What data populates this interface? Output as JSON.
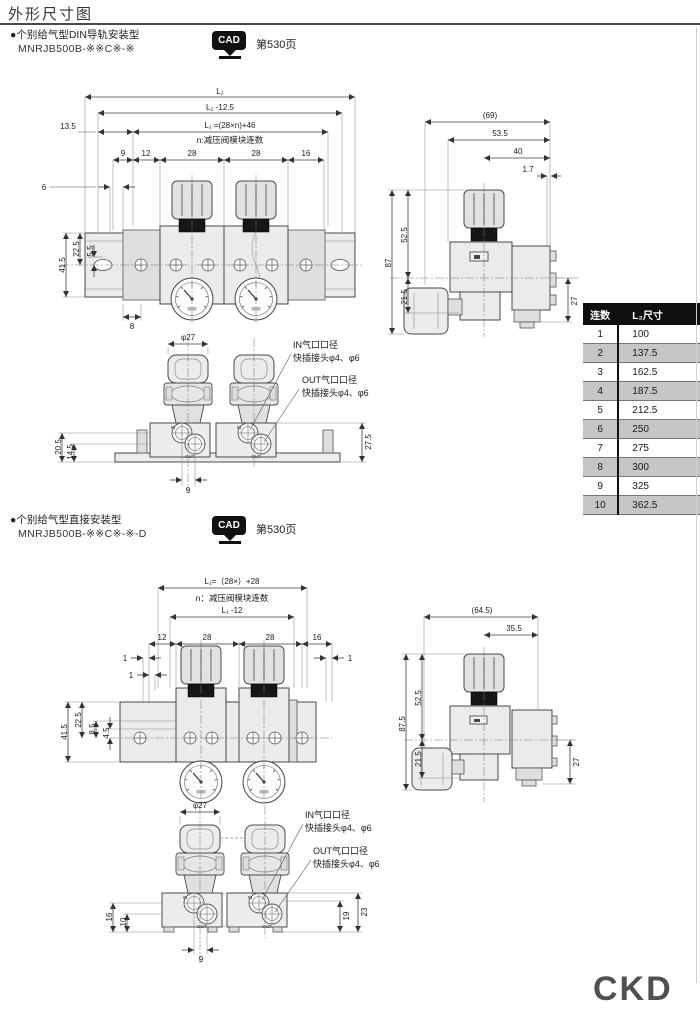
{
  "page": {
    "title": "外形尺寸图",
    "logo": "CKD"
  },
  "section1": {
    "bullet": "●个别给气型DIN导轨安装型",
    "model": "MNRJB500B-※※C※-※",
    "cad_label": "CAD",
    "cad_page": "第530页",
    "front": {
      "l2": "L₂",
      "l2m": "L₂ -12.5",
      "d135": "13.5",
      "l1": "L₁ =(28×n)+46",
      "note": "n:减压阀模块连数",
      "d9": "9",
      "d12": "12",
      "d28a": "28",
      "d28b": "28",
      "d16": "16",
      "d6": "6",
      "d415": "41.5",
      "d225": "22.5",
      "d55": "5.5",
      "d8": "8"
    },
    "side": {
      "d69": "(69)",
      "d535": "53.5",
      "d40": "40",
      "d17": "1.7",
      "d87": "87",
      "d525": "52.5",
      "d215": "21.5",
      "d27": "27"
    },
    "bottom": {
      "phi": "φ27",
      "in1": "IN气口口径",
      "in2": "快插接头φ4、φ6",
      "out1": "OUT气口口径",
      "out2": "快插接头φ4、φ6",
      "d205": "20.5",
      "d145": "14.5",
      "d9": "9",
      "d275": "27.5",
      "pin": "IN",
      "pout": "OUT"
    }
  },
  "table": {
    "col1": "连数",
    "col2": "L₂尺寸",
    "rows": [
      [
        "1",
        "100"
      ],
      [
        "2",
        "137.5"
      ],
      [
        "3",
        "162.5"
      ],
      [
        "4",
        "187.5"
      ],
      [
        "5",
        "212.5"
      ],
      [
        "6",
        "250"
      ],
      [
        "7",
        "275"
      ],
      [
        "8",
        "300"
      ],
      [
        "9",
        "325"
      ],
      [
        "10",
        "362.5"
      ]
    ]
  },
  "section2": {
    "bullet": "●个别给气型直接安装型",
    "model": "MNRJB500B-※※C※-※-D",
    "cad_label": "CAD",
    "cad_page": "第530页",
    "front": {
      "l1": "L₁=（28×）+28",
      "note": "n：减压阀模块连数",
      "l1m": "L₁ -12",
      "d12": "12",
      "d28a": "28",
      "d28b": "28",
      "d16": "16",
      "d1a": "1",
      "d1b": "1",
      "d1c": "1",
      "d415": "41.5",
      "d225": "22.5",
      "d85": "8.5",
      "d45": "4.5"
    },
    "side": {
      "d645": "(64.5)",
      "d355": "35.5",
      "d875": "87.5",
      "d525": "52.5",
      "d215": "21.5",
      "d27": "27"
    },
    "bottom": {
      "phi": "φ27",
      "in1": "IN气口口径",
      "in2": "快插接头φ4、φ6",
      "out1": "OUT气口口径",
      "out2": "快插接头φ4、φ6",
      "d16": "16",
      "d10": "10",
      "d9": "9",
      "d19": "19",
      "d23": "23",
      "pin": "IN",
      "pout": "OUT"
    }
  }
}
